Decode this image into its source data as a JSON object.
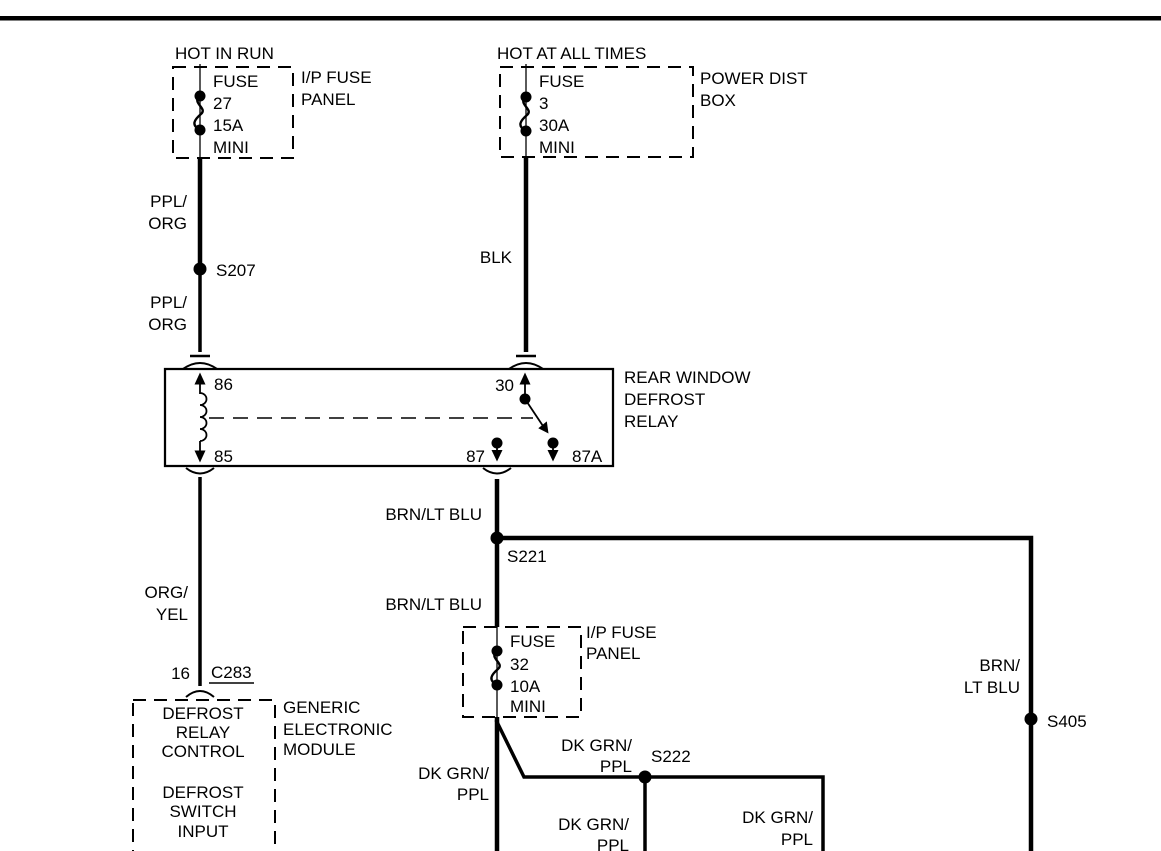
{
  "circuit1": {
    "supply": "HOT IN RUN",
    "fuse": {
      "name": "FUSE",
      "number": "27",
      "rating": "15A",
      "size": "MINI"
    },
    "panel": [
      "I/P FUSE",
      "PANEL"
    ]
  },
  "circuit2": {
    "supply": "HOT AT ALL TIMES",
    "fuse": {
      "name": "FUSE",
      "number": "3",
      "rating": "30A",
      "size": "MINI"
    },
    "panel": [
      "POWER DIST",
      "BOX"
    ]
  },
  "fuse32": {
    "fuse": {
      "name": "FUSE",
      "number": "32",
      "rating": "10A",
      "size": "MINI"
    },
    "panel": [
      "I/P FUSE",
      "PANEL"
    ]
  },
  "relay": {
    "name": [
      "REAR WINDOW",
      "DEFROST",
      "RELAY"
    ],
    "pins": {
      "p86": "86",
      "p85": "85",
      "p30": "30",
      "p87": "87",
      "p87a": "87A"
    }
  },
  "module": {
    "function1": [
      "DEFROST",
      "RELAY",
      "CONTROL"
    ],
    "function2": [
      "DEFROST",
      "SWITCH",
      "INPUT"
    ],
    "name": [
      "GENERIC",
      "ELECTRONIC",
      "MODULE"
    ],
    "connector_pin": "16",
    "connector_id": "C283"
  },
  "splices": {
    "s207": "S207",
    "s221": "S221",
    "s222": "S222",
    "s405": "S405"
  },
  "wire_labels": {
    "ppl_org_upper": [
      "PPL/",
      "ORG"
    ],
    "ppl_org_lower": [
      "PPL/",
      "ORG"
    ],
    "blk": "BLK",
    "brn_ltblu_upper": "BRN/LT BLU",
    "brn_ltblu_lower": "BRN/LT BLU",
    "org_yel": [
      "ORG/",
      "YEL"
    ],
    "brn_ltblu_right": [
      "BRN/",
      "LT BLU"
    ],
    "dkgrn_ppl_left": [
      "DK GRN/",
      "PPL"
    ],
    "dkgrn_ppl_branch": [
      "DK GRN/",
      "PPL"
    ],
    "dkgrn_ppl_below": [
      "DK GRN/",
      "PPL"
    ],
    "dkgrn_ppl_right": [
      "DK GRN/",
      "PPL"
    ]
  }
}
